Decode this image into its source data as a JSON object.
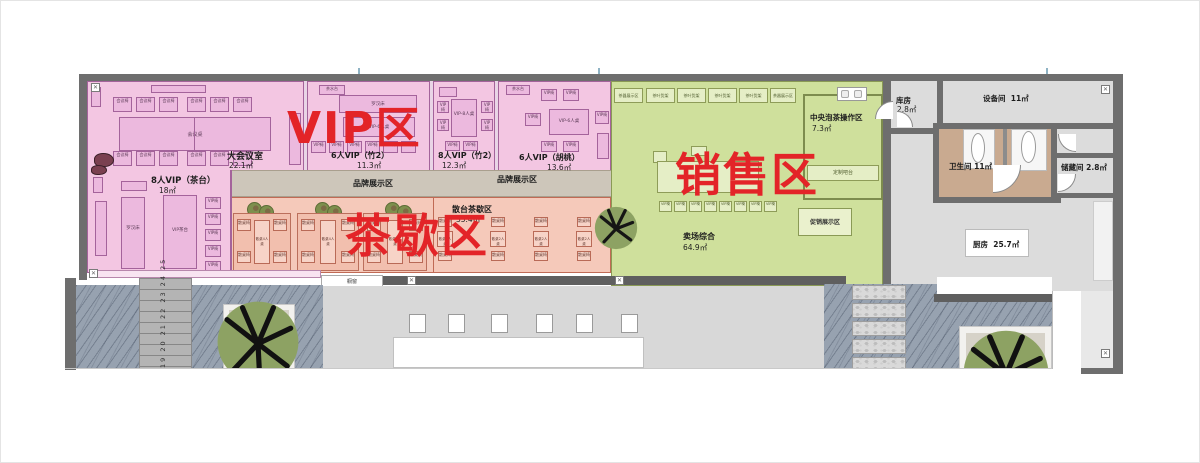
{
  "zones": {
    "vip": {
      "label": "VIP区"
    },
    "teabreak": {
      "label": "茶歇区"
    },
    "sales": {
      "label": "销售区"
    }
  },
  "rooms": {
    "conference": {
      "name": "大会议室",
      "area": "22.1㎡"
    },
    "vip6zhu": {
      "name": "6人VIP（竹2）",
      "area": "11.3㎡"
    },
    "vip8zhu": {
      "name": "8人VIP（竹2）",
      "area": "12.3㎡"
    },
    "vip6walnut": {
      "name": "6人VIP（胡桃）",
      "area": "13.6㎡"
    },
    "vip8tea": {
      "name": "8人VIP（茶台）",
      "area": "18㎡"
    },
    "brand": {
      "name": "品牌展示区"
    },
    "teabreak_tables": {
      "name": "散台茶歇区",
      "area": "35.4㎡"
    },
    "central_tea": {
      "name": "中央泡茶操作区",
      "area": "7.3㎡"
    },
    "promo": {
      "name": "促销展示区"
    },
    "sales_floor": {
      "name": "卖场综合",
      "area": "64.9㎡"
    },
    "storeroom": {
      "name": "库房",
      "area": "2.8㎡"
    },
    "equipment": {
      "name": "设备间",
      "area": "11㎡"
    },
    "washroom": {
      "name": "卫生间",
      "area": "11㎡"
    },
    "storage": {
      "name": "储藏间",
      "area": "2.8㎡"
    },
    "kitchen": {
      "name": "厨房",
      "area": "25.7㎡"
    }
  },
  "furniture": {
    "meeting_chair": "会议椅",
    "meeting_table": "会议桌",
    "vip_chair": "VIP椅",
    "vip_table6": "VIP-6人桌",
    "vip_table8": "VIP-8人桌",
    "tea_station": "茶水台",
    "luohan_bed": "罗汉床",
    "vip_tea_table": "VIP茶台",
    "loose_table4": "散桌4人桌",
    "loose_table2": "散桌2人桌",
    "loose_chair": "散桌椅",
    "tea_shelf": "茶叶货架",
    "teaware_shelf": "茶器展示区",
    "custom_bar": "定制吧台",
    "display_window": "橱窗"
  },
  "site": {
    "stair_numbers": "19 20 21 22 23 24 25"
  },
  "colors": {
    "zone_label_red": "#e32428",
    "vip_fill": "#f3c6e2",
    "teabreak_fill": "#f5c9ba",
    "sales_fill": "#cfe09c",
    "brand_strip": "#cdc6ba",
    "wall_grey": "#6e6e6e",
    "washroom_tan": "#c9aa90"
  }
}
